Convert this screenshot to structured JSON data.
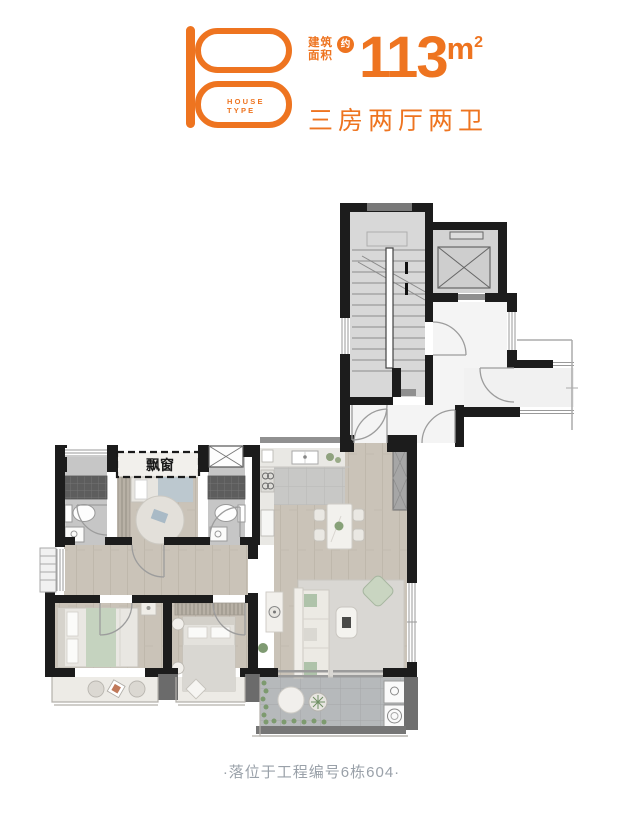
{
  "theme": {
    "accent_color": "#EE7420",
    "wall_color": "#1C1C1C",
    "caption_color": "#9AA1A9"
  },
  "header": {
    "logo": {
      "letter": "B",
      "caption_line1": "HOUSE",
      "caption_line2": "TYPE"
    },
    "area": {
      "label_line1": "建筑",
      "label_line2": "面积",
      "approx_badge": "约",
      "value": "113",
      "unit_letter": "m",
      "unit_exponent": "2"
    },
    "layout_desc": "三房两厅两卫"
  },
  "plan": {
    "bay_window_label": "飘窗"
  },
  "footer": {
    "caption": "·落位于工程编号6栋604·"
  }
}
